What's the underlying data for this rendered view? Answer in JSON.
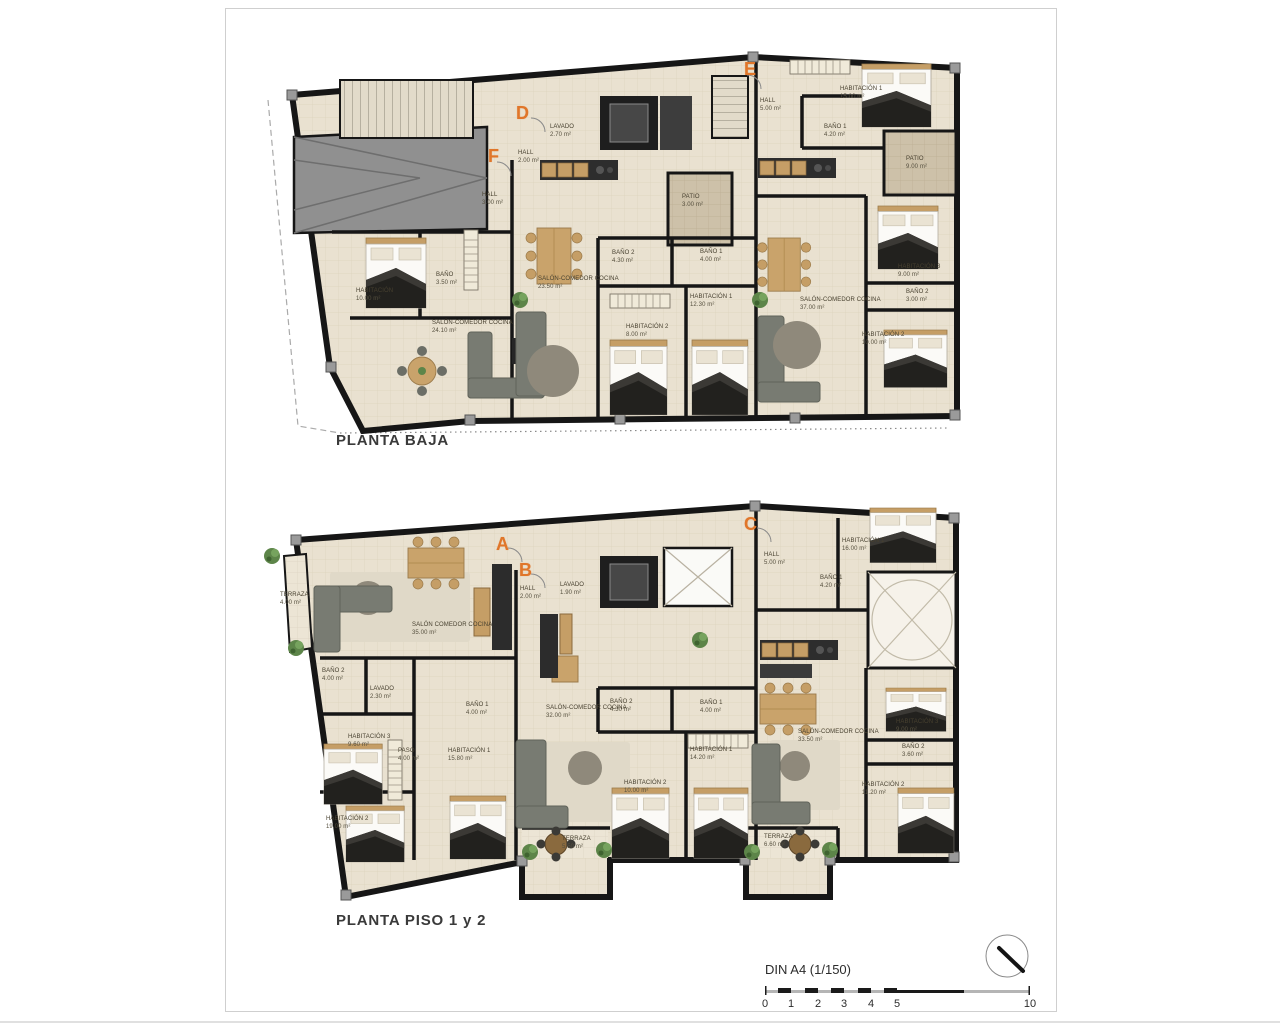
{
  "plans": [
    {
      "title": "PLANTA BAJA",
      "unit_letters": [
        {
          "label": "D",
          "x": 516,
          "y": 103
        },
        {
          "label": "E",
          "x": 744,
          "y": 59
        },
        {
          "label": "F",
          "x": 488,
          "y": 146
        }
      ],
      "rooms": [
        {
          "name": "HABITACIÓN",
          "area": "10.00 m²",
          "x": 356,
          "y": 288
        },
        {
          "name": "BAÑO",
          "area": "3.50 m²",
          "x": 436,
          "y": 272
        },
        {
          "name": "SALÓN-COMEDOR COCINA",
          "area": "24.10 m²",
          "x": 432,
          "y": 320
        },
        {
          "name": "HALL",
          "area": "3.00 m²",
          "x": 482,
          "y": 192
        },
        {
          "name": "HALL",
          "area": "2.00 m²",
          "x": 518,
          "y": 150
        },
        {
          "name": "LAVADO",
          "area": "2.70 m²",
          "x": 550,
          "y": 124
        },
        {
          "name": "SALÓN-COMEDOR COCINA",
          "area": "23.50 m²",
          "x": 538,
          "y": 276
        },
        {
          "name": "PATIO",
          "area": "3.00 m²",
          "x": 682,
          "y": 194
        },
        {
          "name": "BAÑO 2",
          "area": "4.30 m²",
          "x": 612,
          "y": 250
        },
        {
          "name": "BAÑO 1",
          "area": "4.00 m²",
          "x": 700,
          "y": 249
        },
        {
          "name": "HABITACIÓN 1",
          "area": "12.30 m²",
          "x": 690,
          "y": 294
        },
        {
          "name": "HABITACIÓN 2",
          "area": "8.00 m²",
          "x": 626,
          "y": 324
        },
        {
          "name": "HALL",
          "area": "5.00 m²",
          "x": 760,
          "y": 98
        },
        {
          "name": "HABITACIÓN 1",
          "area": "15.00 m²",
          "x": 840,
          "y": 86
        },
        {
          "name": "BAÑO 1",
          "area": "4.20 m²",
          "x": 824,
          "y": 124
        },
        {
          "name": "PATIO",
          "area": "9.00 m²",
          "x": 906,
          "y": 156
        },
        {
          "name": "HABITACIÓN 3",
          "area": "9.00 m²",
          "x": 898,
          "y": 264
        },
        {
          "name": "BAÑO 2",
          "area": "3.00 m²",
          "x": 906,
          "y": 289
        },
        {
          "name": "SALÓN-COMEDOR COCINA",
          "area": "37.00 m²",
          "x": 800,
          "y": 297
        },
        {
          "name": "HABITACIÓN 2",
          "area": "10.00 m²",
          "x": 862,
          "y": 332
        }
      ]
    },
    {
      "title": "PLANTA PISO 1 y 2",
      "unit_letters": [
        {
          "label": "A",
          "x": 496,
          "y": 534
        },
        {
          "label": "B",
          "x": 519,
          "y": 560
        },
        {
          "label": "C",
          "x": 744,
          "y": 514
        }
      ],
      "rooms": [
        {
          "name": "TERRAZA",
          "area": "4.00 m²",
          "x": 280,
          "y": 592
        },
        {
          "name": "SALÓN COMEDOR COCINA",
          "area": "35.00 m²",
          "x": 412,
          "y": 622
        },
        {
          "name": "BAÑO 2",
          "area": "4.00 m²",
          "x": 322,
          "y": 668
        },
        {
          "name": "LAVADO",
          "area": "2.30 m²",
          "x": 370,
          "y": 686
        },
        {
          "name": "HABITACIÓN 3",
          "area": "9.60 m²",
          "x": 348,
          "y": 734
        },
        {
          "name": "PASO",
          "area": "4.00 m²",
          "x": 398,
          "y": 748
        },
        {
          "name": "BAÑO 1",
          "area": "4.00 m²",
          "x": 466,
          "y": 702
        },
        {
          "name": "HABITACIÓN 1",
          "area": "15.80 m²",
          "x": 448,
          "y": 748
        },
        {
          "name": "HABITACIÓN 2",
          "area": "19.00 m²",
          "x": 326,
          "y": 816
        },
        {
          "name": "HALL",
          "area": "2.00 m²",
          "x": 520,
          "y": 586
        },
        {
          "name": "LAVADO",
          "area": "1.90 m²",
          "x": 560,
          "y": 582
        },
        {
          "name": "SALÓN-COMEDOR COCINA",
          "area": "32.00 m²",
          "x": 546,
          "y": 705
        },
        {
          "name": "BAÑO 2",
          "area": "4.30 m²",
          "x": 610,
          "y": 699
        },
        {
          "name": "BAÑO 1",
          "area": "4.00 m²",
          "x": 700,
          "y": 700
        },
        {
          "name": "HABITACIÓN 1",
          "area": "14.20 m²",
          "x": 690,
          "y": 747
        },
        {
          "name": "HABITACIÓN 2",
          "area": "10.00 m²",
          "x": 624,
          "y": 780
        },
        {
          "name": "TERRAZA",
          "area": "5.50 m²",
          "x": 562,
          "y": 836
        },
        {
          "name": "HALL",
          "area": "5.00 m²",
          "x": 764,
          "y": 552
        },
        {
          "name": "HABITACIÓN 1",
          "area": "16.00 m²",
          "x": 842,
          "y": 538
        },
        {
          "name": "BAÑO 1",
          "area": "4.20 m²",
          "x": 820,
          "y": 575
        },
        {
          "name": "SALÓN-COMEDOR COCINA",
          "area": "33.50 m²",
          "x": 798,
          "y": 729
        },
        {
          "name": "HABITACIÓN 3",
          "area": "9.00 m²",
          "x": 896,
          "y": 719
        },
        {
          "name": "BAÑO 2",
          "area": "3.60 m²",
          "x": 902,
          "y": 744
        },
        {
          "name": "HABITACIÓN 2",
          "area": "11.20 m²",
          "x": 862,
          "y": 782
        },
        {
          "name": "TERRAZA",
          "area": "6.60 m²",
          "x": 764,
          "y": 834
        }
      ]
    }
  ],
  "title_block": {
    "scale_label": "DIN A4 (1/150)",
    "scale_ticks": [
      {
        "label": "0",
        "x": 765
      },
      {
        "label": "1",
        "x": 791
      },
      {
        "label": "2",
        "x": 818
      },
      {
        "label": "3",
        "x": 844
      },
      {
        "label": "4",
        "x": 871
      },
      {
        "label": "5",
        "x": 897
      },
      {
        "label": "10",
        "x": 1030
      }
    ]
  },
  "colors": {
    "accent_orange": "#e0762a",
    "wall": "#161616",
    "floor": "#e9e1d0",
    "patio": "#cdc1a9"
  }
}
